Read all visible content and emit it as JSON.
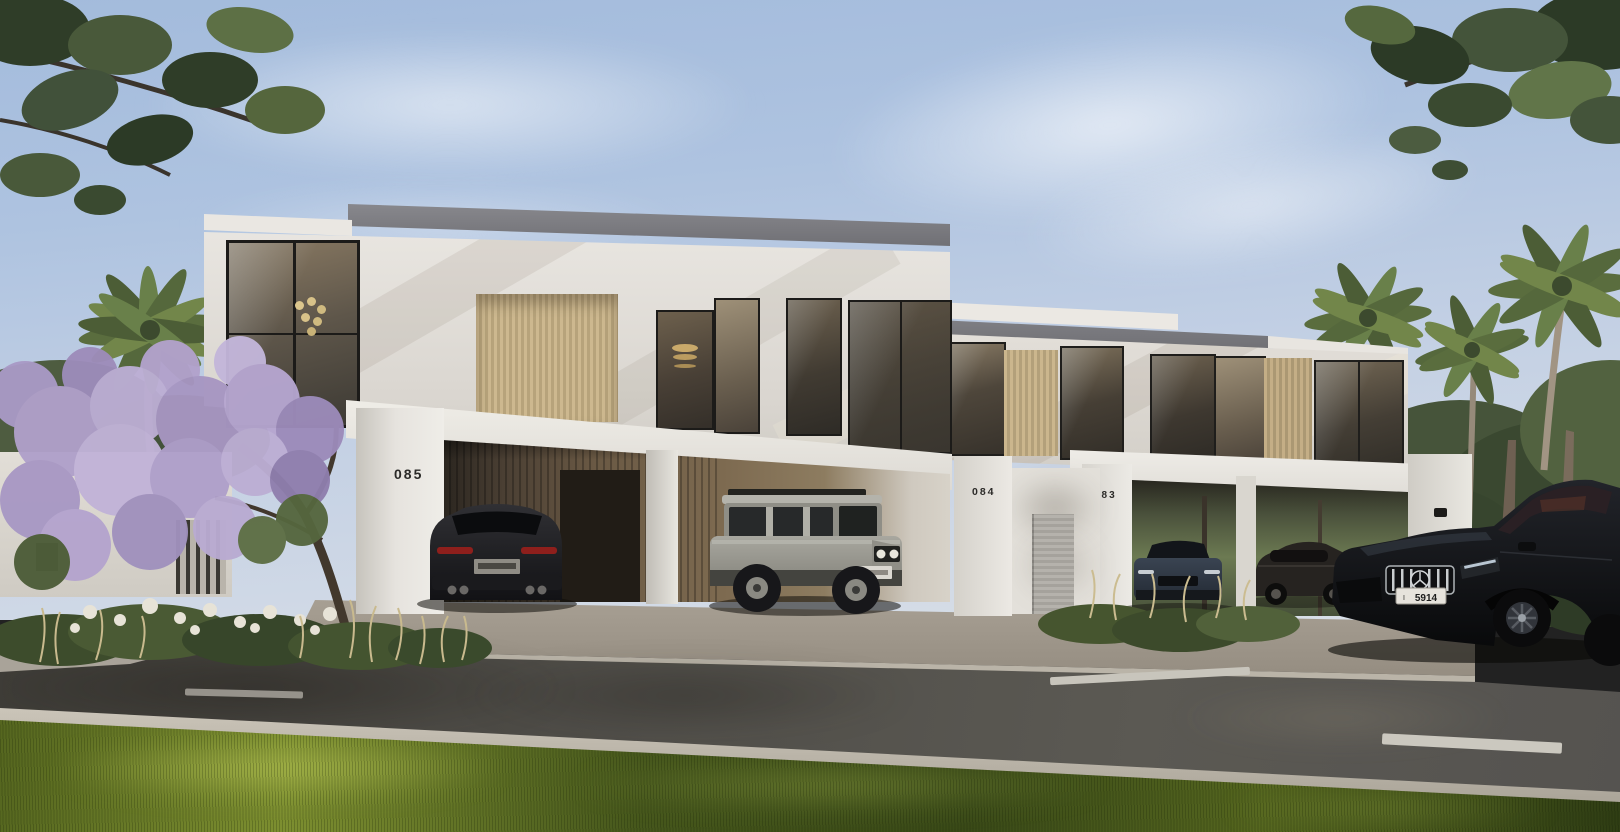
{
  "scene": {
    "house_numbers": [
      "085",
      "084",
      "083"
    ],
    "license_plate_prefix": "I",
    "license_plate_number": "5914"
  },
  "colors": {
    "sky_top": "#a6bddd",
    "sky_horizon": "#d9dfe7",
    "facade_white": "#e8e5e0",
    "facade_shade": "#c9c6c0",
    "roof_fascia": "#76767a",
    "wood_slats": "#c7b28a",
    "glass_dark": "#4a4236",
    "carport_interior": "#4a3f33",
    "asphalt": "#514f4a",
    "curb_concrete": "#c3bdb1",
    "pavers": "#a29a8e",
    "lane_marking": "#c8c5bc",
    "grass_dark": "#44531f",
    "grass_sunlit": "#9fae45",
    "foliage_green": "#45543a",
    "blossom_purple": "#b2a2cc",
    "palm_frond": "#5d7140",
    "car_black_suv": "#121316",
    "car_silver_defender": "#a2a199",
    "car_blue_sedan": "#323b47",
    "car_dark_sedan": "#24211d",
    "house_number_color": "#2b2a28"
  }
}
